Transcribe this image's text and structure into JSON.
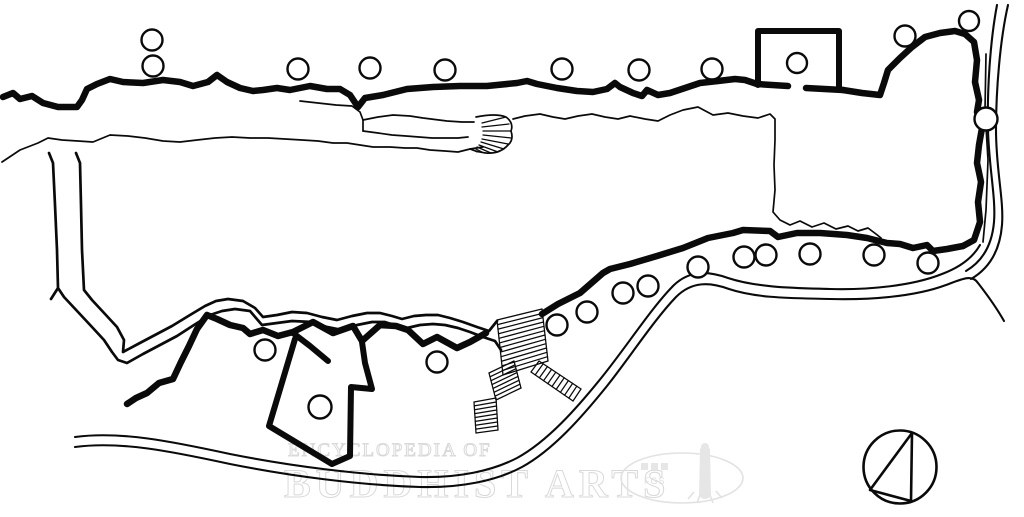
{
  "watermark": {
    "line1": "ENCYCLOPEDIA OF",
    "line2": "BUDDHIST ARTS",
    "logo_text": "FGS",
    "color": "#e2e2e2"
  },
  "colors": {
    "ink": "#0a0a0a",
    "background": "#ffffff",
    "watermark": "#e2e2e2"
  },
  "compass": {
    "cx": 900,
    "cy": 467,
    "r": 36.5,
    "triangle": "M 912 433 L 911 501 L 870 490 Z"
  },
  "plan": {
    "paths": {
      "north_wall": "M 3 97 L 13 93 L 20 99 L 32 96 L 43 103 L 58 107 L 77 107 L 82 100 L 87 89 L 97 84 L 110 79 L 123 82 L 143 83 L 163 80 L 180 82 L 193 86 L 208 82 L 217 75 L 227 82 L 240 88 L 253 91 L 263 90 L 277 88 L 290 90 L 310 86 L 327 89 L 340 89 L 350 95 L 358 107 L 365 98 L 383 95 L 407 89 L 433 87 L 460 86 L 487 86 L 517 83 L 527 81 L 537 84 L 557 88 L 577 91 L 593 92 L 607 89 L 615 83 L 620 87 L 633 93 L 642 96 L 647 90 L 658 95 L 670 93 L 682 89 L 688 87 L 700 83 L 718 81 L 735 79 L 745 80 L 757 84",
      "gatehouse": "M 758 85 L 758 31 L 839 31 L 839 87",
      "gatehouse_door_left": "M 757 84 L 788 86",
      "gatehouse_door_right": "M 806 88 L 843 90",
      "ne_wall": "M 843 90 L 862 93 L 880 95 L 884 83 L 888 70 L 900 58 L 912 47 L 925 37 L 940 33 L 955 31 L 965 34 L 974 42 L 977 60 L 975 82 L 979 100 L 977 112 L 982 128 L 979 145 L 977 163 L 981 182 L 978 202 L 980 222 L 974 240 L 963 246",
      "south_wall_east": "M 963 246 L 947 249 L 933 251 L 927 245 L 913 248 L 900 244 L 887 243 L 867 238 L 847 235 L 820 233 L 797 233 L 778 237 L 770 231 L 743 230 L 733 233 L 708 238 L 683 248 L 657 256 L 630 264 L 610 269 L 603 273 L 580 293 L 558 304 L 542 314",
      "south_wall_west": "M 486 333 L 470 342 L 457 348 L 437 337 L 423 344 L 408 330 L 396 326 L 380 325 L 362 341 L 353 326 L 333 333 L 313 322 L 293 332 L 278 336 L 263 330 L 250 334 L 243 328 L 230 325 L 217 319 L 207 315 L 197 329 L 189 346 L 181 362 L 173 379 L 159 383 L 147 393 L 136 398 L 127 404",
      "door_jamb": "M 293 333 L 310 346 L 328 361",
      "building": "M 295 339 L 269 426 L 332 464 L 350 456 L 351 387 L 372 389 L 365 363 L 362 342",
      "lake_north_shore": "M 2 162 L 20 150 L 38 143 L 48 138 L 62 140 L 78 141 L 93 142 L 110 135 L 128 136 L 145 138 L 163 141 L 180 142 L 197 140 L 215 138 L 232 137 L 250 138 L 268 138 L 285 139 L 302 140 L 318 141 L 333 143 L 347 143 L 360 145 L 373 147 L 390 147 L 405 148 L 417 148 L 430 150 L 445 151 L 458 152 L 470 149 L 483 147",
      "walkway_top": "M 300 101 L 318 103 L 336 105 L 352 106 L 360 112 L 363 120 L 378 117 L 393 115 L 410 116 L 423 118 L 447 121 L 462 122 L 474 122",
      "walkway_left": "M 363 120 L 363 131",
      "walkway_bottom": "M 363 131 L 378 133 L 392 135 L 406 136 L 419 137 L 432 138 L 445 138 L 458 138 L 468 137",
      "fan_arc": "M 476 117 Q 496 113 506 117 Q 514 123 511 131 Q 514 140 508 145 Q 500 154 486 153 Q 477 152 470 149",
      "lake_east_shore": "M 513 119 L 525 116 L 540 114 L 553 117 L 565 119 L 578 116 L 592 114 L 605 117 L 618 119 L 630 116 L 645 119 L 658 121 L 670 115 L 683 110 L 698 107 L 713 115 L 728 113 L 743 116 L 758 118 L 770 114 L 775 119 L 775 140 L 774 165 L 775 190 L 773 212 L 780 220 L 790 225 L 800 221 L 812 227 L 824 223 L 836 229 L 848 226 L 858 231 L 868 228 L 876 234 L 881 238",
      "bank_inner": "M 76 153 L 80 163 L 81 205 L 82 250 L 84 290 L 92 300 L 105 314 L 117 327 L 124 340 L 123 352 L 138 344 L 155 335 L 172 326 L 190 315 L 205 306 L 216 301 L 228 299 L 243 301 L 255 308 L 263 317 L 277 315 L 292 312 L 307 313 L 322 317 L 337 320 L 352 316 L 367 313 L 380 313 L 392 316 L 402 319 L 414 316 L 426 315 L 438 315 L 450 318 L 463 322 L 477 327 L 489 331 L 497 321",
      "bank_outer": "M 49 153 L 53 163 L 55 205 L 57 250 L 58 288 L 51 299 M 58 288 L 64 297 L 78 312 L 92 327 L 104 340 L 112 352 L 118 360 L 127 363 L 143 354 L 160 345 L 177 336 L 194 325 L 210 315 L 222 311 L 235 309 L 250 311 L 262 325 L 277 323 L 292 321 L 312 322 L 327 327 L 342 330 L 357 325 L 372 322 L 385 322 L 397 326 L 407 328 L 420 325 L 433 324 L 445 325 L 458 328 L 470 332 L 483 337 L 495 341 L 501 350",
      "road_upper": "M 75 437 C 120 431 170 441 230 454 C 290 466 360 475 420 477 C 458 478 492 471 517 458 C 548 441 577 408 602 377 C 627 346 652 307 674 285 C 690 270 708 271 728 278 C 758 288 798 288 830 289 C 868 290 912 286 942 274 C 958 268 972 259 980 245",
      "road_lower": "M 75 447 C 120 441 170 451 230 464 C 290 476 358 485 420 487 C 460 488 496 481 522 467 C 553 450 582 417 607 386 C 630 357 654 320 676 297 C 692 281 710 282 729 289 C 759 299 798 298 830 299 C 868 300 914 297 946 285 C 962 279 972 274 978 283 C 985 292 995 305 1004 321",
      "road_right_outer": "M 1008 5 C 1000 40 996 90 996 130 C 996 170 1004 200 1002 225 C 1000 250 990 268 971 279",
      "road_right_inner": "M 997 5 C 990 42 987 92 988 130 C 989 168 996 198 994 222 C 992 245 983 261 966 271",
      "wall_side_line": "M 986 54 L 985 110 L 988 160 L 986 210 L 983 242"
    },
    "circles": [
      [
        152,
        40,
        10.5
      ],
      [
        153,
        66,
        10.5
      ],
      [
        298,
        69,
        10.5
      ],
      [
        370,
        68,
        10.5
      ],
      [
        445,
        70,
        10.5
      ],
      [
        562,
        69,
        10.5
      ],
      [
        639,
        70,
        10.5
      ],
      [
        712,
        69,
        10.5
      ],
      [
        797,
        63,
        10
      ],
      [
        905,
        36,
        10.5
      ],
      [
        969,
        21,
        10
      ],
      [
        986,
        119,
        11.5
      ],
      [
        557,
        325,
        10.5
      ],
      [
        587,
        312,
        10.5
      ],
      [
        623,
        293,
        10.5
      ],
      [
        648,
        286,
        10.5
      ],
      [
        698,
        267,
        10.5
      ],
      [
        744,
        257,
        10.5
      ],
      [
        766,
        255,
        10.5
      ],
      [
        810,
        254,
        10.5
      ],
      [
        874,
        255,
        10.5
      ],
      [
        928,
        263,
        10.5
      ],
      [
        265,
        350,
        10.5
      ],
      [
        320,
        407,
        11.5
      ],
      [
        437,
        362,
        10.5
      ]
    ],
    "stairs": [
      {
        "edgeA": [
          [
            497,
            320
          ],
          [
            503,
            375
          ]
        ],
        "edgeB": [
          [
            542,
            309
          ],
          [
            548,
            361
          ]
        ],
        "steps": 13
      },
      {
        "edgeA": [
          [
            489,
            373
          ],
          [
            496,
            400
          ]
        ],
        "edgeB": [
          [
            514,
            361
          ],
          [
            521,
            388
          ]
        ],
        "steps": 8
      },
      {
        "edgeA": [
          [
            474,
            402
          ],
          [
            476,
            433
          ]
        ],
        "edgeB": [
          [
            496,
            398
          ],
          [
            498,
            430
          ]
        ],
        "steps": 9
      },
      {
        "edgeA": [
          [
            539,
            361
          ],
          [
            581,
            389
          ]
        ],
        "edgeB": [
          [
            531,
            372
          ],
          [
            573,
            401
          ]
        ],
        "steps": 11
      }
    ],
    "fan_spokes": [
      [
        482,
        123,
        506,
        117
      ],
      [
        482,
        127,
        509,
        124
      ],
      [
        483,
        131,
        511,
        131
      ],
      [
        483,
        135,
        511,
        138
      ],
      [
        482,
        139,
        508,
        144
      ],
      [
        481,
        142,
        504,
        149
      ],
      [
        479,
        145,
        498,
        152
      ],
      [
        477,
        147,
        491,
        153
      ],
      [
        474,
        148,
        484,
        153
      ],
      [
        471,
        149,
        477,
        152
      ]
    ]
  }
}
